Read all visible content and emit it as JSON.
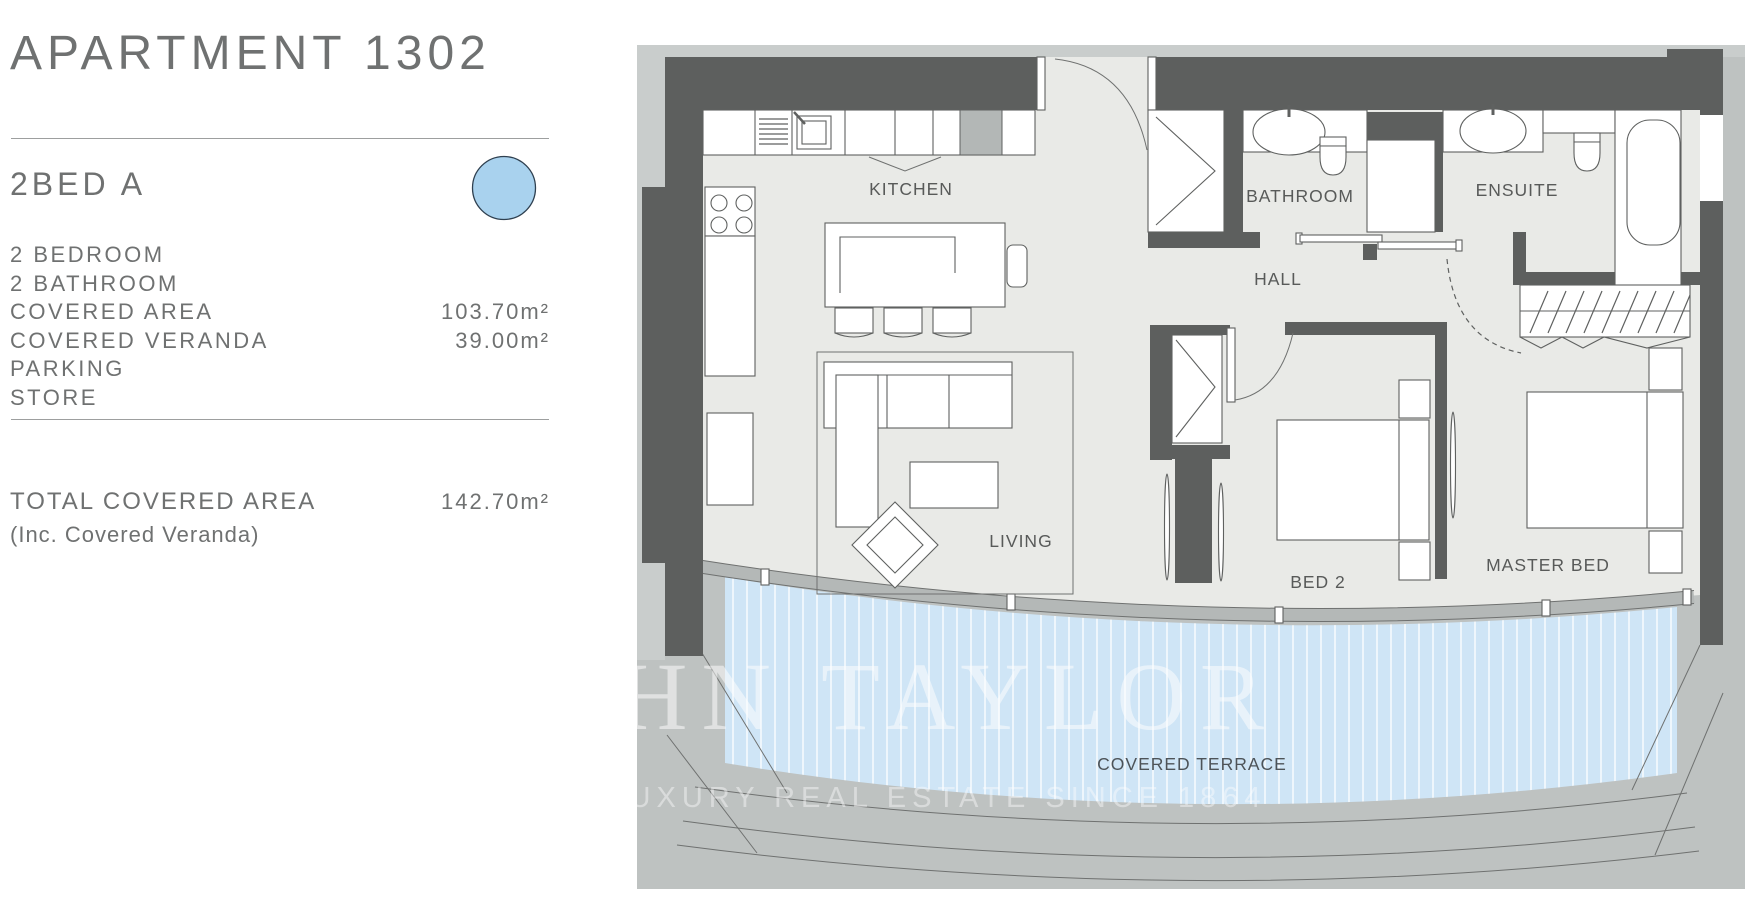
{
  "panel": {
    "title": "APARTMENT 1302",
    "unit_name": "2BED A",
    "legend_dot_color": "#a9d2ee",
    "specs": [
      {
        "label": "2 BEDROOM",
        "value": ""
      },
      {
        "label": "2 BATHROOM",
        "value": ""
      },
      {
        "label": "COVERED AREA",
        "value": "103.70m²"
      },
      {
        "label": "COVERED VERANDA",
        "value": "39.00m²"
      },
      {
        "label": "PARKING",
        "value": ""
      },
      {
        "label": "STORE",
        "value": ""
      }
    ],
    "total_label": "TOTAL COVERED AREA",
    "total_value": "142.70m²",
    "total_note": "(Inc. Covered Veranda)"
  },
  "plan": {
    "labels": {
      "kitchen": "KITCHEN",
      "bathroom": "BATHROOM",
      "ensuite": "ENSUITE",
      "hall": "HALL",
      "living": "LIVING",
      "bed2": "BED 2",
      "master": "MASTER BED",
      "terrace": "COVERED TERRACE"
    },
    "watermark_line1": "HN TAYLOR",
    "watermark_line2": "LUXURY REAL ESTATE SINCE 1864",
    "colors": {
      "wall": "#5d5f5e",
      "floor": "#e9eae7",
      "surround": "#bec2c1",
      "surround_light": "#c9cdcc",
      "glass_band": "#b4b8b7",
      "terrace_blue": "#cfe5f6",
      "appliance_gray": "#b3b7b6"
    }
  }
}
